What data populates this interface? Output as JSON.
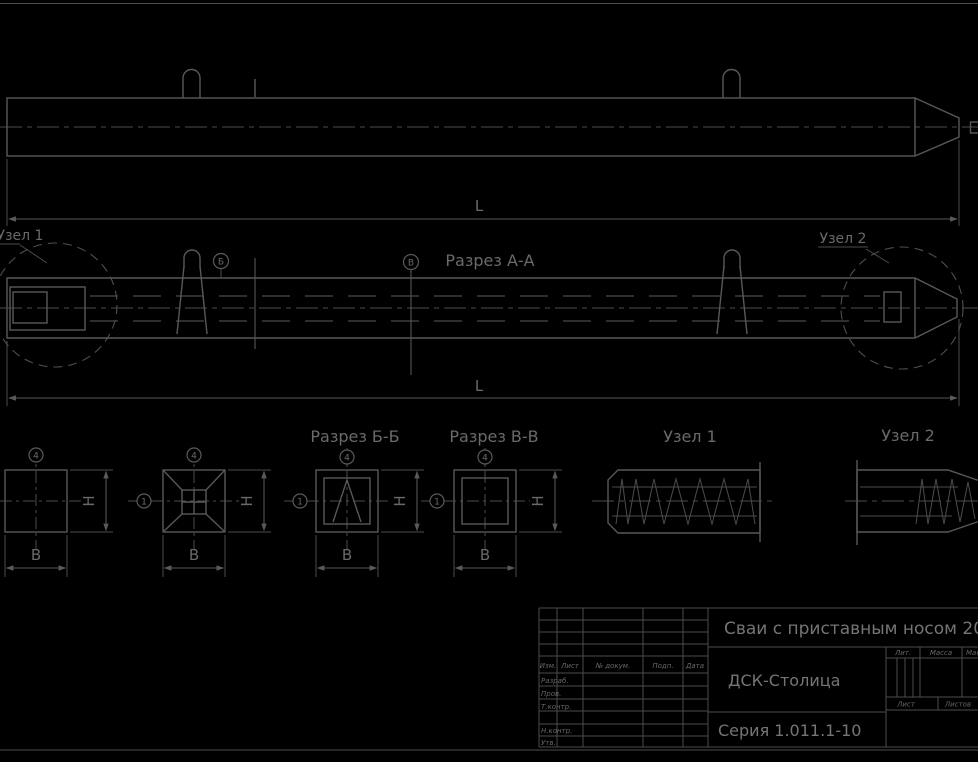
{
  "colors": {
    "background": "#000000",
    "line": "#585858",
    "hatch": "#434343",
    "text": "#6e6e6e"
  },
  "views": {
    "plan": {
      "dim_length": "L"
    },
    "section_aa": {
      "title": "Разрез А-А",
      "dim_length": "L",
      "node1_callout": "Узел 1",
      "node2_callout": "Узел 2",
      "cut_mark_b": "Б",
      "cut_mark_v": "В"
    },
    "end_view": {
      "balloon_top": "4",
      "dim_h": "H",
      "dim_b": "B"
    },
    "head_view": {
      "balloon_top": "4",
      "balloon_left": "1",
      "dim_h": "H",
      "dim_b": "B"
    },
    "section_bb": {
      "title": "Разрез Б-Б",
      "balloon_top": "4",
      "balloon_left": "1",
      "dim_h": "H",
      "dim_b": "B"
    },
    "section_vv": {
      "title": "Разрез В-В",
      "balloon_top": "4",
      "balloon_left": "1",
      "dim_h": "H",
      "dim_b": "B"
    },
    "node1": {
      "title": "Узел 1"
    },
    "node2": {
      "title": "Узел 2"
    }
  },
  "title_block": {
    "doc_title": "Сваи с приставным носом 200x2",
    "company": "ДСК-Столица",
    "series": "Серия 1.011.1-10",
    "columns": {
      "izm": "Изм.",
      "list": "Лист",
      "dokum": "№ докум.",
      "podp": "Подп.",
      "data": "Дата"
    },
    "rows": {
      "razrab": "Разраб.",
      "prov": "Пров.",
      "tkontr": "Т.контр.",
      "nkontr": "Н.контр.",
      "utv": "Утв."
    },
    "right": {
      "lit": "Лит.",
      "massa": "Масса",
      "masshtab": "Масштаб",
      "list": "Лист",
      "listov": "Листов"
    }
  }
}
